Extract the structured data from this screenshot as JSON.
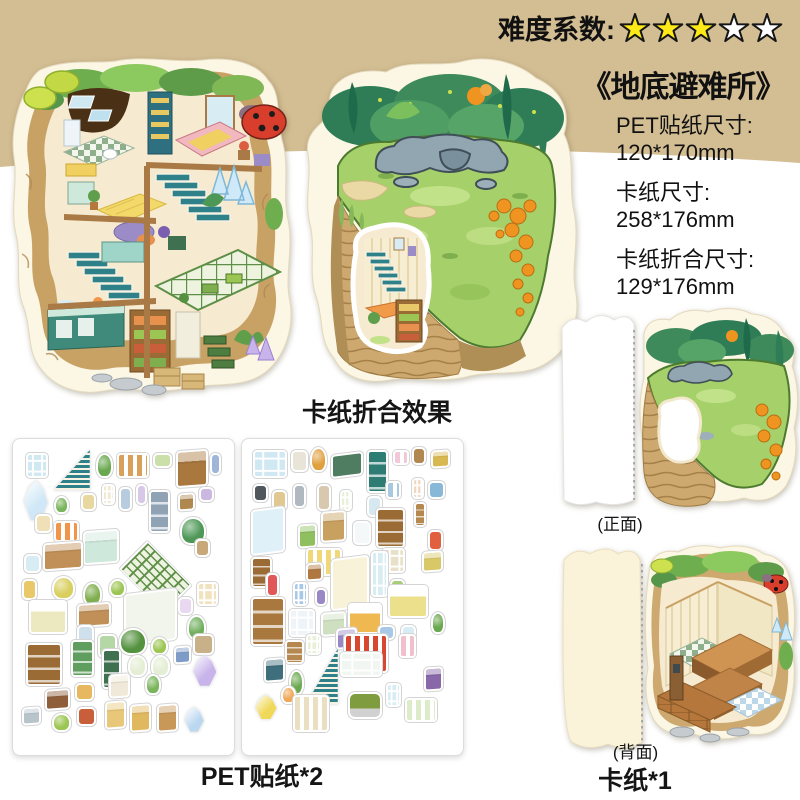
{
  "colors": {
    "band": "#d3bd93",
    "text": "#111111",
    "star_fill": "#ffe917",
    "star_empty": "#ffffff",
    "star_stroke": "#161616"
  },
  "difficulty": {
    "label": "难度系数:",
    "filled": 3,
    "total": 5
  },
  "product": {
    "title": "《地底避难所》",
    "specs": [
      {
        "k": "PET贴纸尺寸:",
        "v": "120*170mm"
      },
      {
        "k": "卡纸尺寸:",
        "v": "258*176mm"
      },
      {
        "k": "卡纸折合尺寸:",
        "v": "129*176mm"
      }
    ]
  },
  "captions": {
    "folded_effect": "卡纸折合效果",
    "sticker_sheets": "PET贴纸*2",
    "card_count": "卡纸*1",
    "front": "(正面)",
    "back": "(背面)"
  },
  "sheets": [
    {
      "stickers": [
        {
          "x": 4,
          "y": 3,
          "w": 10,
          "h": 8,
          "k": "window",
          "c": "#cfe8f2"
        },
        {
          "x": 17,
          "y": 2,
          "w": 17,
          "h": 13,
          "k": "stairs",
          "c": "#2e8089"
        },
        {
          "x": 37,
          "y": 3,
          "w": 8,
          "h": 8,
          "k": "plant",
          "c": "#6aa84f"
        },
        {
          "x": 47,
          "y": 3,
          "w": 15,
          "h": 8,
          "k": "rug",
          "c": "#d9a05b"
        },
        {
          "x": 64,
          "y": 3,
          "w": 9,
          "h": 5,
          "k": "misc",
          "c": "#cbe0a8"
        },
        {
          "x": 75,
          "y": 2,
          "w": 15,
          "h": 12,
          "k": "box",
          "c": "#a9783f"
        },
        {
          "x": 91,
          "y": 3,
          "w": 5,
          "h": 7,
          "k": "misc",
          "c": "#9fb6d8"
        },
        {
          "x": 3,
          "y": 12,
          "w": 11,
          "h": 13,
          "k": "crystal",
          "c": "#cfe7f6"
        },
        {
          "x": 17,
          "y": 17,
          "w": 7,
          "h": 6,
          "k": "plant",
          "c": "#7ab55c"
        },
        {
          "x": 30,
          "y": 16,
          "w": 7,
          "h": 6,
          "k": "misc",
          "c": "#e8d8a0"
        },
        {
          "x": 40,
          "y": 13,
          "w": 6,
          "h": 7,
          "k": "window",
          "c": "#f0e8d0"
        },
        {
          "x": 48,
          "y": 14,
          "w": 6,
          "h": 8,
          "k": "misc",
          "c": "#b8cce0"
        },
        {
          "x": 56,
          "y": 13,
          "w": 5,
          "h": 7,
          "k": "misc",
          "c": "#d8c8e8"
        },
        {
          "x": 62,
          "y": 15,
          "w": 10,
          "h": 14,
          "k": "shelf",
          "c": "#8fa3b5"
        },
        {
          "x": 76,
          "y": 16,
          "w": 8,
          "h": 6,
          "k": "box",
          "c": "#b08850"
        },
        {
          "x": 86,
          "y": 14,
          "w": 7,
          "h": 5,
          "k": "misc",
          "c": "#cbb8e0"
        },
        {
          "x": 8,
          "y": 23,
          "w": 8,
          "h": 6,
          "k": "misc",
          "c": "#f0e0b8"
        },
        {
          "x": 17,
          "y": 25,
          "w": 12,
          "h": 7,
          "k": "rug",
          "c": "#f0954a"
        },
        {
          "x": 77,
          "y": 24,
          "w": 12,
          "h": 9,
          "k": "plant",
          "c": "#4e9857"
        },
        {
          "x": 31,
          "y": 28,
          "w": 17,
          "h": 11,
          "k": "box",
          "c": "#cfe8dc"
        },
        {
          "x": 12,
          "y": 32,
          "w": 19,
          "h": 9,
          "k": "box",
          "c": "#c09058"
        },
        {
          "x": 3,
          "y": 36,
          "w": 8,
          "h": 6,
          "k": "misc",
          "c": "#d8ecf4"
        },
        {
          "x": 50,
          "y": 33,
          "w": 30,
          "h": 21,
          "k": "grid",
          "c": "#5d8f46"
        },
        {
          "x": 84,
          "y": 31,
          "w": 7,
          "h": 6,
          "k": "misc",
          "c": "#c8a878"
        },
        {
          "x": 2,
          "y": 44,
          "w": 7,
          "h": 7,
          "k": "misc",
          "c": "#e8c868"
        },
        {
          "x": 16,
          "y": 43,
          "w": 11,
          "h": 8,
          "k": "plant",
          "c": "#d8cf5e"
        },
        {
          "x": 31,
          "y": 45,
          "w": 9,
          "h": 8,
          "k": "plant",
          "c": "#7fae4e"
        },
        {
          "x": 43,
          "y": 44,
          "w": 8,
          "h": 6,
          "k": "plant",
          "c": "#9cc653"
        },
        {
          "x": 85,
          "y": 45,
          "w": 10,
          "h": 8,
          "k": "window",
          "c": "#f2e3c0"
        },
        {
          "x": 5,
          "y": 51,
          "w": 18,
          "h": 11,
          "k": "bed",
          "c": "#ece8c0"
        },
        {
          "x": 28,
          "y": 52,
          "w": 16,
          "h": 8,
          "k": "box",
          "c": "#c09058"
        },
        {
          "x": 76,
          "y": 50,
          "w": 7,
          "h": 6,
          "k": "misc",
          "c": "#e8d8f0"
        },
        {
          "x": 50,
          "y": 48,
          "w": 25,
          "h": 17,
          "k": "panel",
          "c": "#f2f5ec"
        },
        {
          "x": 80,
          "y": 56,
          "w": 9,
          "h": 8,
          "k": "plant",
          "c": "#6fae5c"
        },
        {
          "x": 28,
          "y": 59,
          "w": 8,
          "h": 7,
          "k": "misc",
          "c": "#cfe0ec"
        },
        {
          "x": 38,
          "y": 62,
          "w": 9,
          "h": 8,
          "k": "misc",
          "c": "#b5d7a5"
        },
        {
          "x": 48,
          "y": 60,
          "w": 13,
          "h": 9,
          "k": "plant",
          "c": "#55923f"
        },
        {
          "x": 63,
          "y": 63,
          "w": 8,
          "h": 6,
          "k": "plant",
          "c": "#9cc653"
        },
        {
          "x": 83,
          "y": 62,
          "w": 10,
          "h": 7,
          "k": "misc",
          "c": "#c8b088"
        },
        {
          "x": 4,
          "y": 65,
          "w": 17,
          "h": 14,
          "k": "shelf",
          "c": "#9a6b35"
        },
        {
          "x": 25,
          "y": 64,
          "w": 11,
          "h": 12,
          "k": "shelf",
          "c": "#5f9e5f"
        },
        {
          "x": 40,
          "y": 67,
          "w": 9,
          "h": 13,
          "k": "shelf",
          "c": "#3f7050"
        },
        {
          "x": 52,
          "y": 69,
          "w": 9,
          "h": 7,
          "k": "plant",
          "c": "#e4eed4"
        },
        {
          "x": 63,
          "y": 69,
          "w": 9,
          "h": 7,
          "k": "plant",
          "c": "#e4eed4"
        },
        {
          "x": 74,
          "y": 66,
          "w": 8,
          "h": 6,
          "k": "box",
          "c": "#7f9cc8"
        },
        {
          "x": 83,
          "y": 69,
          "w": 11,
          "h": 10,
          "k": "crystal",
          "c": "#c8b4ea"
        },
        {
          "x": 13,
          "y": 80,
          "w": 12,
          "h": 7,
          "k": "box",
          "c": "#8f5f3a"
        },
        {
          "x": 27,
          "y": 78,
          "w": 9,
          "h": 6,
          "k": "misc",
          "c": "#e8b860"
        },
        {
          "x": 43,
          "y": 75,
          "w": 10,
          "h": 8,
          "k": "box",
          "c": "#f0e8d8"
        },
        {
          "x": 60,
          "y": 75,
          "w": 8,
          "h": 7,
          "k": "plant",
          "c": "#7ab55c"
        },
        {
          "x": 2,
          "y": 86,
          "w": 9,
          "h": 6,
          "k": "box",
          "c": "#b8c4cc"
        },
        {
          "x": 16,
          "y": 88,
          "w": 9,
          "h": 6,
          "k": "plant",
          "c": "#9cc653"
        },
        {
          "x": 28,
          "y": 86,
          "w": 9,
          "h": 6,
          "k": "misc",
          "c": "#c85f3a"
        },
        {
          "x": 41,
          "y": 84,
          "w": 10,
          "h": 9,
          "k": "box",
          "c": "#e8c878"
        },
        {
          "x": 53,
          "y": 85,
          "w": 10,
          "h": 9,
          "k": "box",
          "c": "#e0b860"
        },
        {
          "x": 66,
          "y": 85,
          "w": 10,
          "h": 9,
          "k": "box",
          "c": "#c89858"
        },
        {
          "x": 79,
          "y": 86,
          "w": 9,
          "h": 8,
          "k": "crystal",
          "c": "#bcd8f0"
        }
      ]
    },
    {
      "stickers": [
        {
          "x": 3,
          "y": 2,
          "w": 16,
          "h": 9,
          "k": "window",
          "c": "#cfe8f2"
        },
        {
          "x": 21,
          "y": 2,
          "w": 8,
          "h": 7,
          "k": "misc",
          "c": "#e8e4d8"
        },
        {
          "x": 30,
          "y": 1,
          "w": 8,
          "h": 8,
          "k": "plant",
          "c": "#e0a040"
        },
        {
          "x": 40,
          "y": 3,
          "w": 15,
          "h": 8,
          "k": "panel",
          "c": "#4e7d62"
        },
        {
          "x": 57,
          "y": 2,
          "w": 10,
          "h": 14,
          "k": "shelf",
          "c": "#2e7d74"
        },
        {
          "x": 69,
          "y": 2,
          "w": 8,
          "h": 5,
          "k": "rug",
          "c": "#f0c8d8"
        },
        {
          "x": 78,
          "y": 1,
          "w": 7,
          "h": 6,
          "k": "misc",
          "c": "#b08850"
        },
        {
          "x": 87,
          "y": 2,
          "w": 9,
          "h": 6,
          "k": "box",
          "c": "#d8b850"
        },
        {
          "x": 3,
          "y": 13,
          "w": 7,
          "h": 6,
          "k": "misc",
          "c": "#50585e"
        },
        {
          "x": 12,
          "y": 15,
          "w": 7,
          "h": 7,
          "k": "misc",
          "c": "#e0c890"
        },
        {
          "x": 22,
          "y": 13,
          "w": 6,
          "h": 8,
          "k": "misc",
          "c": "#b0b8c0"
        },
        {
          "x": 33,
          "y": 13,
          "w": 7,
          "h": 9,
          "k": "misc",
          "c": "#d8c8b0"
        },
        {
          "x": 44,
          "y": 15,
          "w": 6,
          "h": 7,
          "k": "window",
          "c": "#e8f0d8"
        },
        {
          "x": 57,
          "y": 17,
          "w": 7,
          "h": 7,
          "k": "misc",
          "c": "#d8e8f0"
        },
        {
          "x": 66,
          "y": 12,
          "w": 7,
          "h": 6,
          "k": "rug",
          "c": "#a8c8e0"
        },
        {
          "x": 78,
          "y": 11,
          "w": 6,
          "h": 7,
          "k": "window",
          "c": "#f0d8c0"
        },
        {
          "x": 86,
          "y": 12,
          "w": 8,
          "h": 6,
          "k": "misc",
          "c": "#88b8d8"
        },
        {
          "x": 2,
          "y": 21,
          "w": 16,
          "h": 15,
          "k": "panel",
          "c": "#dff0f8"
        },
        {
          "x": 24,
          "y": 26,
          "w": 9,
          "h": 8,
          "k": "box",
          "c": "#8fbf5f"
        },
        {
          "x": 35,
          "y": 22,
          "w": 12,
          "h": 10,
          "k": "box",
          "c": "#c8a060"
        },
        {
          "x": 50,
          "y": 25,
          "w": 9,
          "h": 8,
          "k": "misc",
          "c": "#f4f8f8"
        },
        {
          "x": 61,
          "y": 21,
          "w": 14,
          "h": 13,
          "k": "shelf",
          "c": "#9a6b35"
        },
        {
          "x": 79,
          "y": 19,
          "w": 6,
          "h": 8,
          "k": "shelf",
          "c": "#b58850"
        },
        {
          "x": 86,
          "y": 28,
          "w": 7,
          "h": 7,
          "k": "misc",
          "c": "#e06040"
        },
        {
          "x": 28,
          "y": 34,
          "w": 17,
          "h": 9,
          "k": "rug",
          "c": "#f0d878"
        },
        {
          "x": 64,
          "y": 34,
          "w": 11,
          "h": 8,
          "k": "window",
          "c": "#e8e0c8"
        },
        {
          "x": 83,
          "y": 35,
          "w": 10,
          "h": 7,
          "k": "box",
          "c": "#d8c868"
        },
        {
          "x": 2,
          "y": 37,
          "w": 10,
          "h": 10,
          "k": "shelf",
          "c": "#9a6b35"
        },
        {
          "x": 28,
          "y": 39,
          "w": 8,
          "h": 6,
          "k": "box",
          "c": "#b07840"
        },
        {
          "x": 40,
          "y": 37,
          "w": 18,
          "h": 17,
          "k": "panel",
          "c": "#f7f2d8"
        },
        {
          "x": 59,
          "y": 35,
          "w": 8,
          "h": 15,
          "k": "window",
          "c": "#d8ecf4"
        },
        {
          "x": 9,
          "y": 42,
          "w": 6,
          "h": 8,
          "k": "misc",
          "c": "#e05858"
        },
        {
          "x": 68,
          "y": 44,
          "w": 7,
          "h": 5,
          "k": "misc",
          "c": "#a8cc78"
        },
        {
          "x": 22,
          "y": 45,
          "w": 7,
          "h": 8,
          "k": "window",
          "c": "#a8c8e8"
        },
        {
          "x": 32,
          "y": 47,
          "w": 6,
          "h": 6,
          "k": "misc",
          "c": "#9888c8"
        },
        {
          "x": 2,
          "y": 50,
          "w": 16,
          "h": 16,
          "k": "shelf",
          "c": "#a9783f"
        },
        {
          "x": 20,
          "y": 54,
          "w": 12,
          "h": 9,
          "k": "window",
          "c": "#eef4f8"
        },
        {
          "x": 35,
          "y": 55,
          "w": 12,
          "h": 8,
          "k": "box",
          "c": "#cfe0c0"
        },
        {
          "x": 48,
          "y": 52,
          "w": 16,
          "h": 10,
          "k": "bed",
          "c": "#f0b850"
        },
        {
          "x": 67,
          "y": 46,
          "w": 19,
          "h": 11,
          "k": "bed",
          "c": "#ece08c"
        },
        {
          "x": 87,
          "y": 55,
          "w": 7,
          "h": 7,
          "k": "plant",
          "c": "#6aa84f"
        },
        {
          "x": 62,
          "y": 59,
          "w": 8,
          "h": 5,
          "k": "misc",
          "c": "#a8c8e8"
        },
        {
          "x": 73,
          "y": 59,
          "w": 7,
          "h": 5,
          "k": "misc",
          "c": "#d8ecf4"
        },
        {
          "x": 42,
          "y": 60,
          "w": 10,
          "h": 7,
          "k": "box",
          "c": "#9888c8"
        },
        {
          "x": 28,
          "y": 62,
          "w": 7,
          "h": 7,
          "k": "window",
          "c": "#e8f0d8"
        },
        {
          "x": 18,
          "y": 64,
          "w": 9,
          "h": 8,
          "k": "shelf",
          "c": "#b58850"
        },
        {
          "x": 28,
          "y": 67,
          "w": 15,
          "h": 18,
          "k": "stairs",
          "c": "#2e8089"
        },
        {
          "x": 46,
          "y": 62,
          "w": 21,
          "h": 13,
          "k": "rug",
          "c": "#d84830"
        },
        {
          "x": 72,
          "y": 62,
          "w": 8,
          "h": 8,
          "k": "rug",
          "c": "#f0c0cc"
        },
        {
          "x": 44,
          "y": 68,
          "w": 20,
          "h": 8,
          "k": "window",
          "c": "#f2f6f2"
        },
        {
          "x": 8,
          "y": 70,
          "w": 10,
          "h": 8,
          "k": "box",
          "c": "#3f6e7d"
        },
        {
          "x": 20,
          "y": 74,
          "w": 7,
          "h": 8,
          "k": "plant",
          "c": "#6aa84f"
        },
        {
          "x": 84,
          "y": 73,
          "w": 9,
          "h": 8,
          "k": "box",
          "c": "#8868a8"
        },
        {
          "x": 4,
          "y": 82,
          "w": 10,
          "h": 8,
          "k": "crystal",
          "c": "#f0d858"
        },
        {
          "x": 16,
          "y": 79,
          "w": 7,
          "h": 6,
          "k": "plant",
          "c": "#f0a858"
        },
        {
          "x": 22,
          "y": 82,
          "w": 17,
          "h": 12,
          "k": "rug",
          "c": "#eadfc0"
        },
        {
          "x": 48,
          "y": 81,
          "w": 16,
          "h": 9,
          "k": "sofa",
          "c": "#7f9c3f"
        },
        {
          "x": 66,
          "y": 78,
          "w": 7,
          "h": 8,
          "k": "window",
          "c": "#d8ecf4"
        },
        {
          "x": 75,
          "y": 83,
          "w": 15,
          "h": 8,
          "k": "rug",
          "c": "#dcecc8"
        }
      ]
    }
  ]
}
